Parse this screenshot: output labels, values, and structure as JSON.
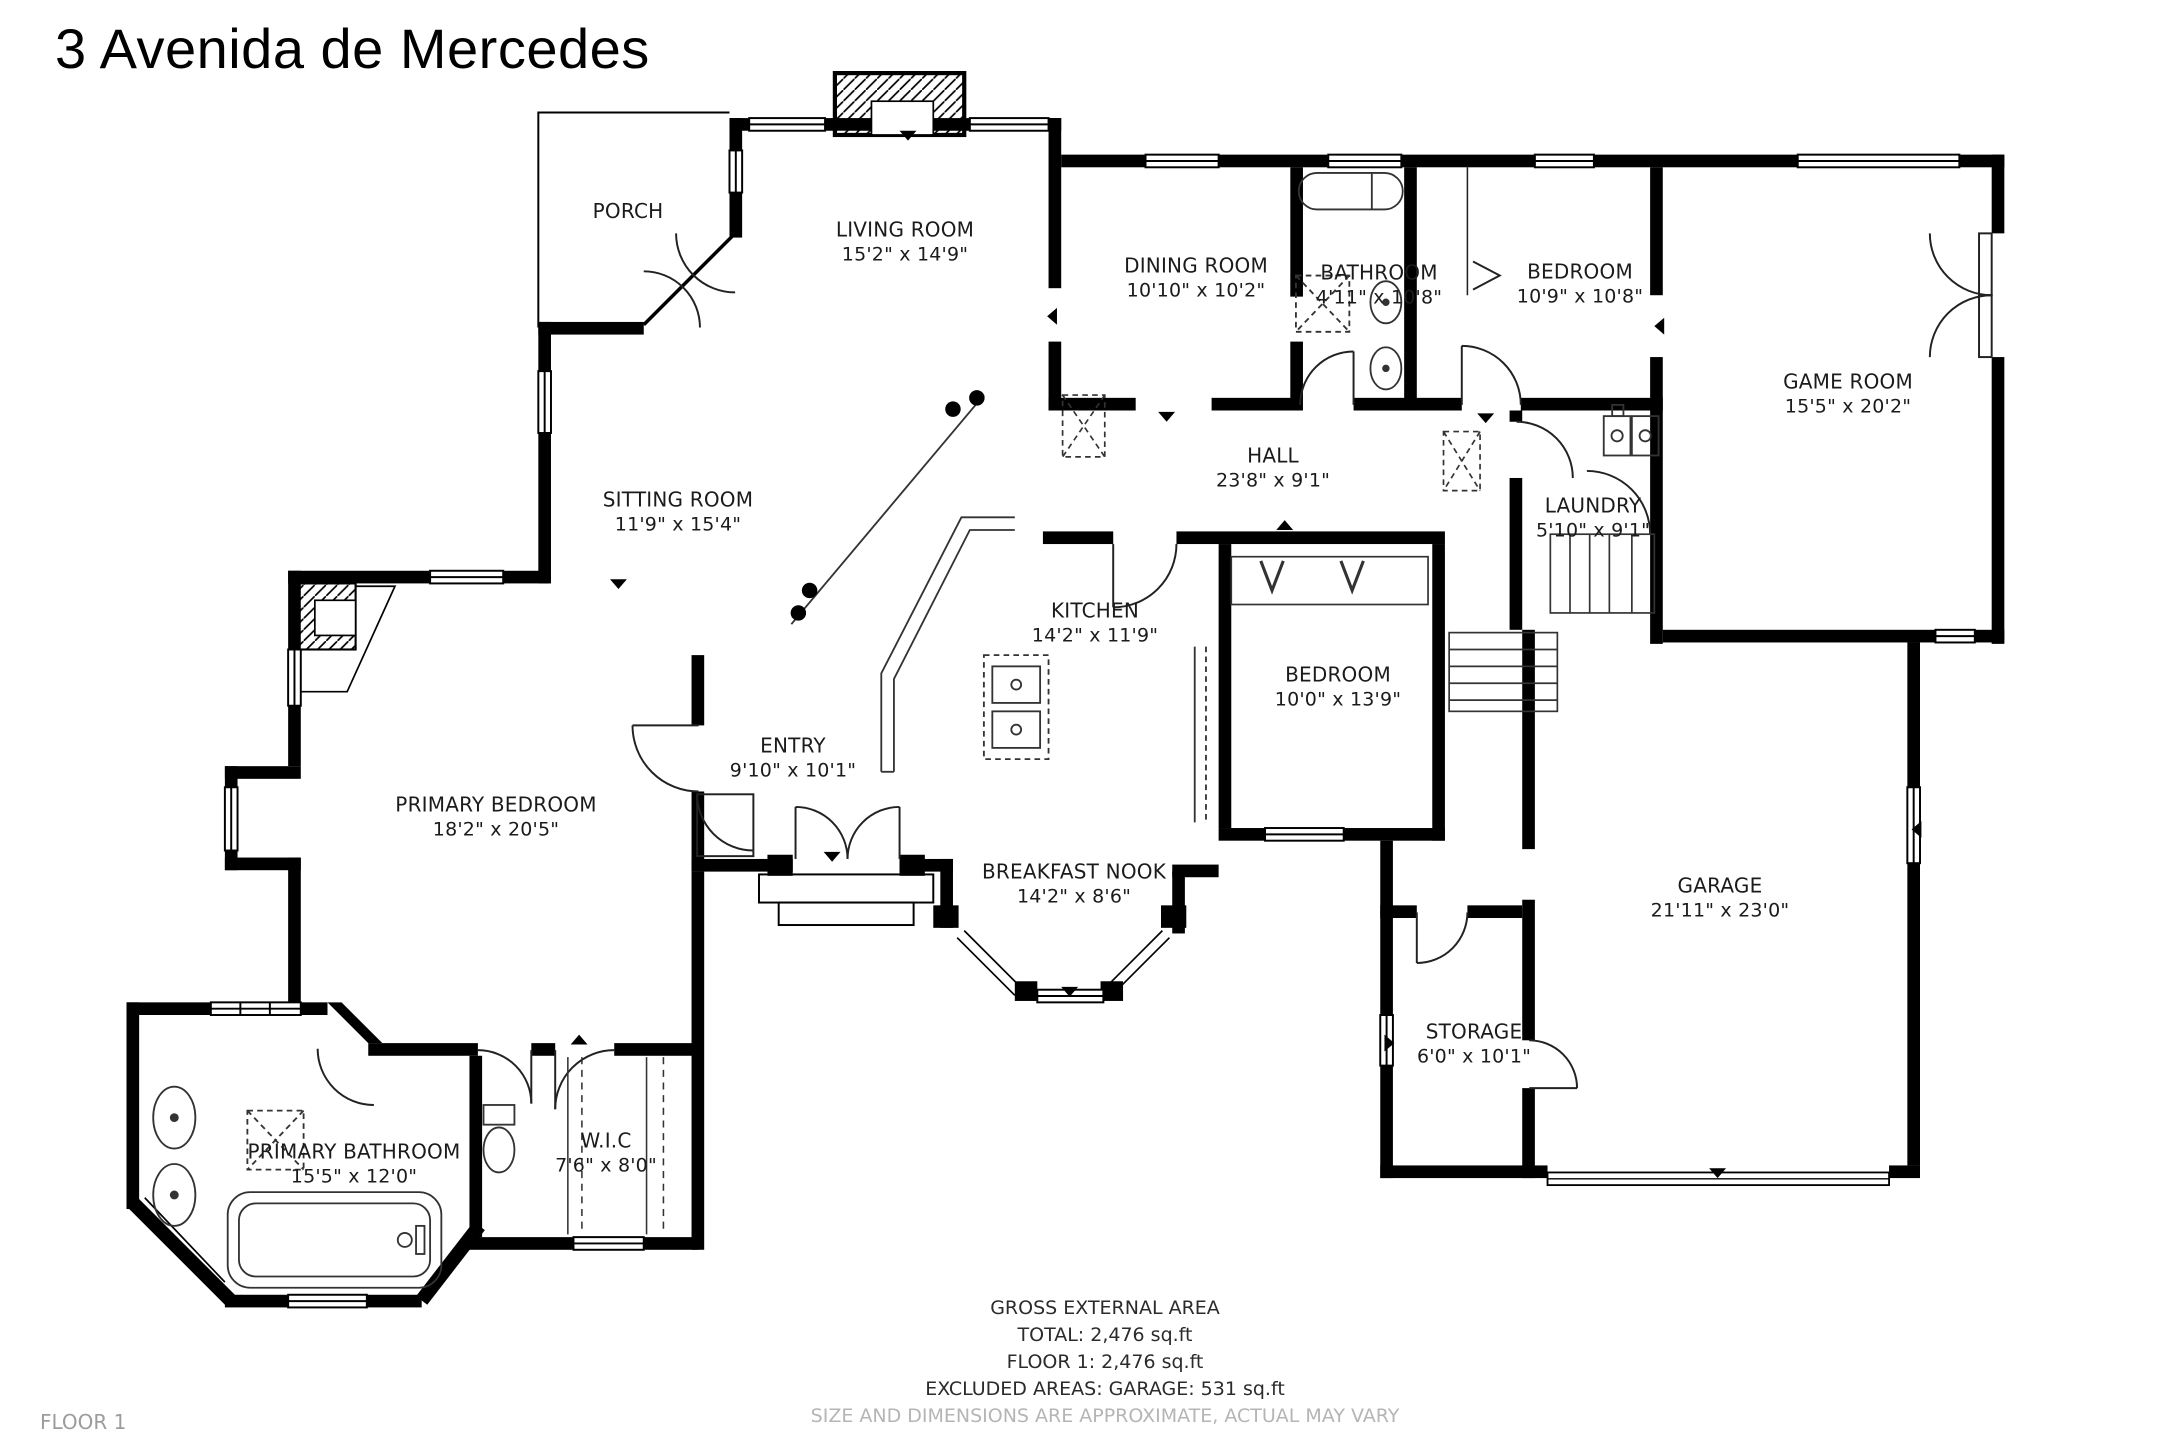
{
  "title": "3 Avenida de Mercedes",
  "floor_label": "FLOOR 1",
  "rooms": [
    {
      "name": "PORCH",
      "dims": ""
    },
    {
      "name": "LIVING ROOM",
      "dims": "15'2\" x 14'9\""
    },
    {
      "name": "DINING ROOM",
      "dims": "10'10\" x 10'2\""
    },
    {
      "name": "BATHROOM",
      "dims": "4'11\" x 10'8\""
    },
    {
      "name": "BEDROOM",
      "dims": "10'9\" x 10'8\""
    },
    {
      "name": "GAME ROOM",
      "dims": "15'5\" x 20'2\""
    },
    {
      "name": "SITTING ROOM",
      "dims": "11'9\" x 15'4\""
    },
    {
      "name": "HALL",
      "dims": "23'8\" x 9'1\""
    },
    {
      "name": "LAUNDRY",
      "dims": "5'10\" x 9'1\""
    },
    {
      "name": "KITCHEN",
      "dims": "14'2\" x 11'9\""
    },
    {
      "name": "BEDROOM",
      "dims": "10'0\" x 13'9\""
    },
    {
      "name": "ENTRY",
      "dims": "9'10\" x 10'1\""
    },
    {
      "name": "PRIMARY BEDROOM",
      "dims": "18'2\" x 20'5\""
    },
    {
      "name": "BREAKFAST NOOK",
      "dims": "14'2\" x 8'6\""
    },
    {
      "name": "GARAGE",
      "dims": "21'11\" x 23'0\""
    },
    {
      "name": "STORAGE",
      "dims": "6'0\" x 10'1\""
    },
    {
      "name": "PRIMARY BATHROOM",
      "dims": "15'5\" x 12'0\""
    },
    {
      "name": "W.I.C",
      "dims": "7'6\" x 8'0\""
    }
  ],
  "footer": {
    "heading": "GROSS EXTERNAL AREA",
    "total": "TOTAL: 2,476 sq.ft",
    "floor1": "FLOOR 1: 2,476 sq.ft",
    "excluded": "EXCLUDED AREAS: GARAGE: 531 sq.ft",
    "disclaimer": "SIZE AND DIMENSIONS ARE APPROXIMATE, ACTUAL MAY VARY"
  },
  "colors": {
    "wall": "#000000",
    "label": "#1b1b1b",
    "muted": "#b5b5b5"
  }
}
